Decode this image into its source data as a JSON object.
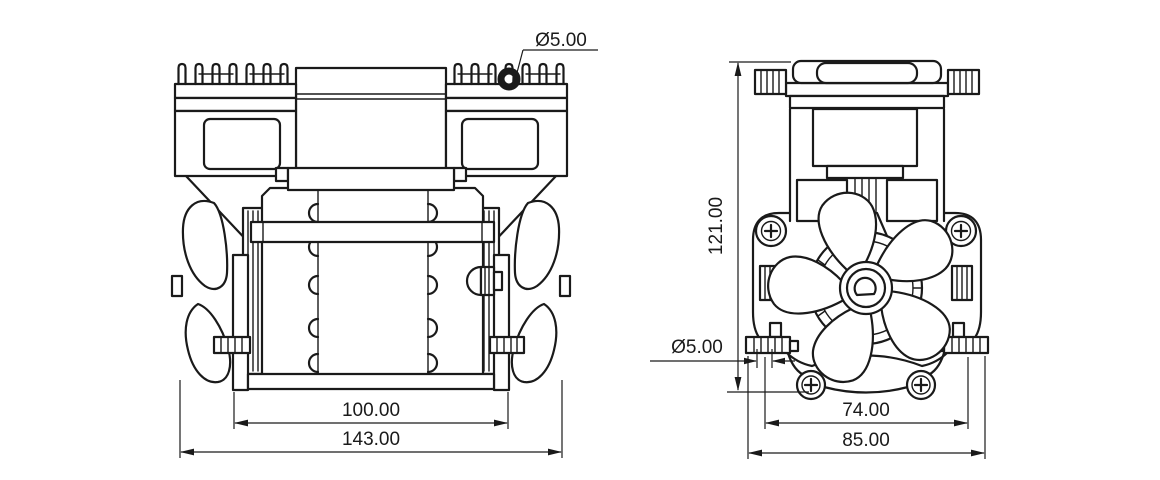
{
  "colors": {
    "background": "#ffffff",
    "ink": "#1a1a1a"
  },
  "dimensions": {
    "front_hole": "Ø5.00",
    "front_inner_width": "100.00",
    "front_overall_width": "143.00",
    "side_height": "121.00",
    "side_foot_hole": "Ø5.00",
    "side_hole_spacing": "74.00",
    "side_overall_width": "85.00"
  }
}
